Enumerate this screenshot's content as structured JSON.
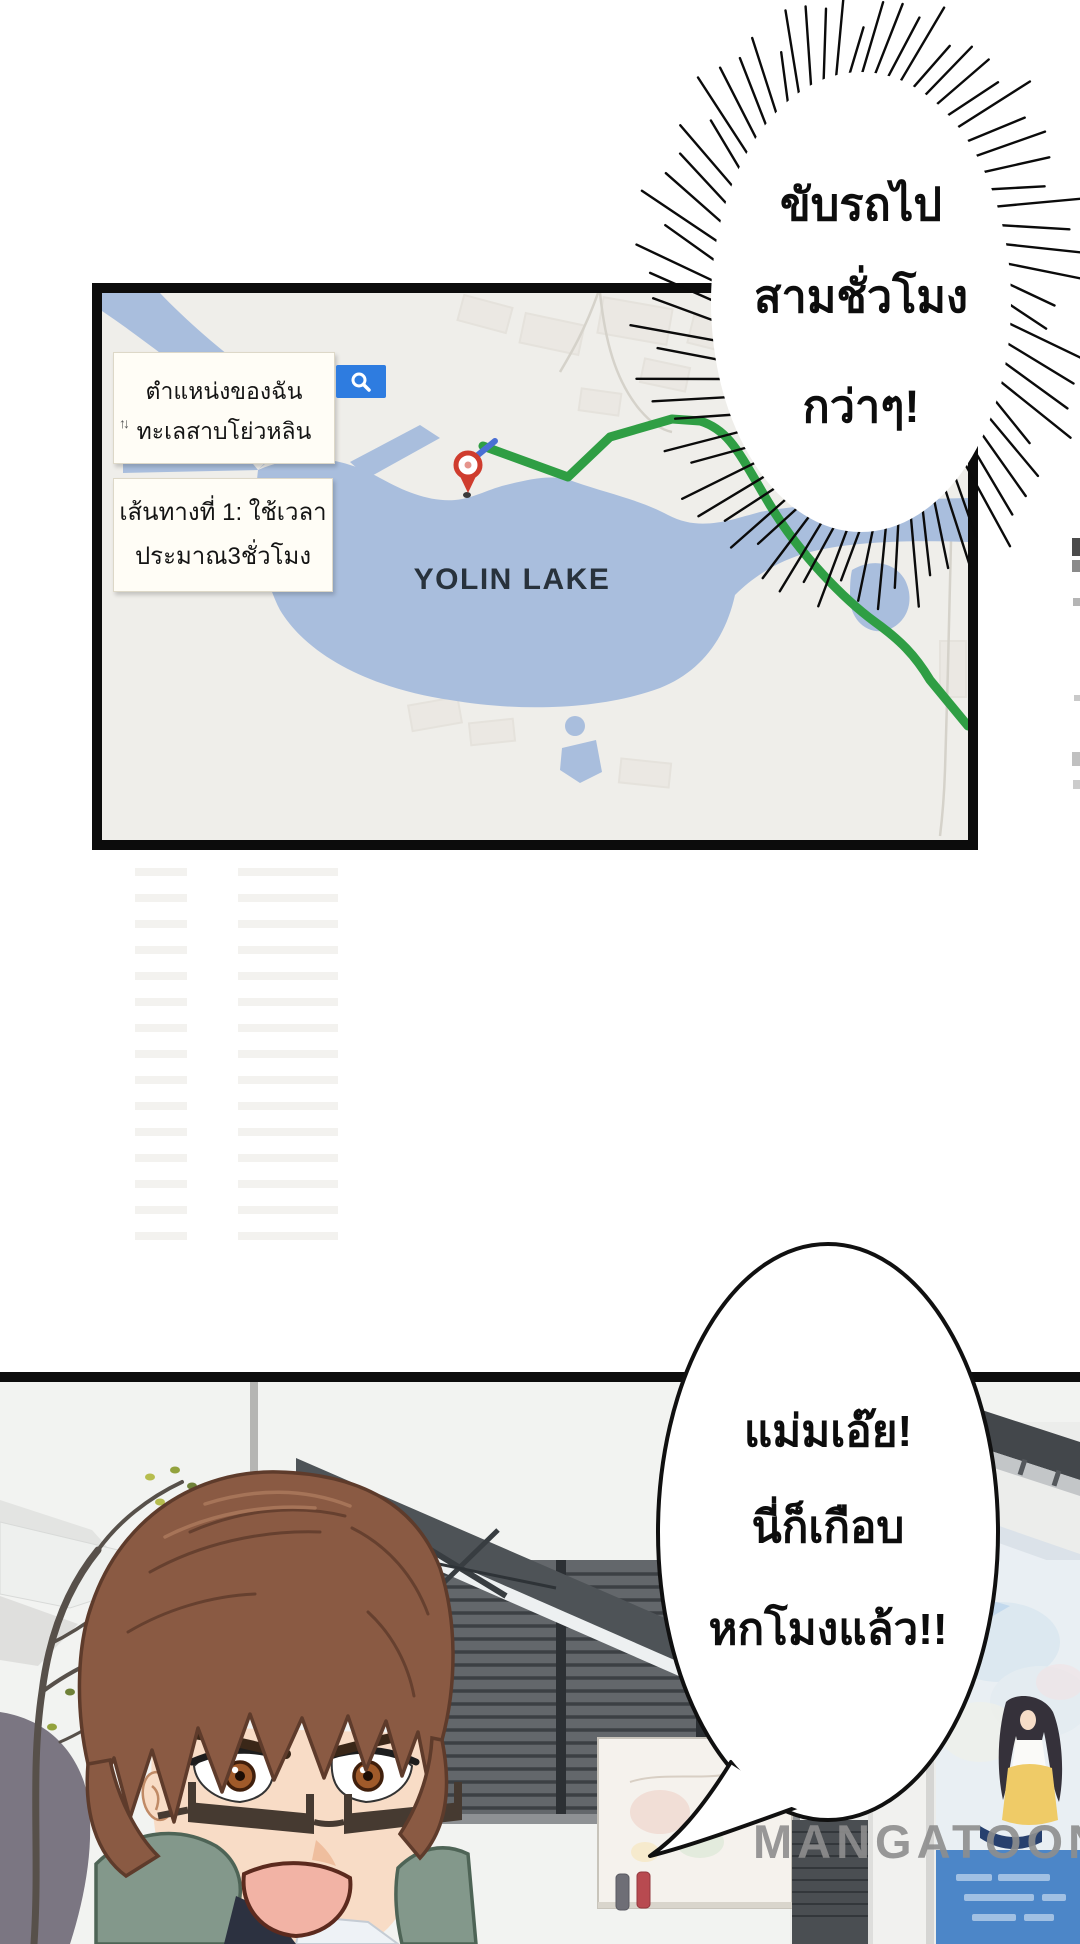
{
  "page": {
    "type": "comic-page"
  },
  "top_bubble": {
    "line1": "ขับรถไป",
    "line2": "สามชั่วโมง",
    "line3": "กว่าๆ!"
  },
  "map": {
    "search_label_line1": "ตำแหน่งของฉัน",
    "search_label_line2": "ทะเลสาบโย่วหลิน",
    "swap_icon": "↑↓",
    "route_label_line1": "เส้นทางที่ 1: ใช้เวลา",
    "route_label_line2": "ประมาณ3ชั่วโมง",
    "lake_name": "YOLIN LAKE",
    "colors": {
      "water": "#a9bedd",
      "route_green": "#2f9e44",
      "search_button_blue": "#2e7ce0",
      "pin_red": "#cf3c2e",
      "map_background": "#efeeea"
    }
  },
  "bottom_bubble": {
    "line1": "แม่มเอ๊ย!",
    "line2": "นี่ก็เกือบ",
    "line3": "หกโมงแล้ว!!"
  },
  "watermark_text": "MANGATOON"
}
